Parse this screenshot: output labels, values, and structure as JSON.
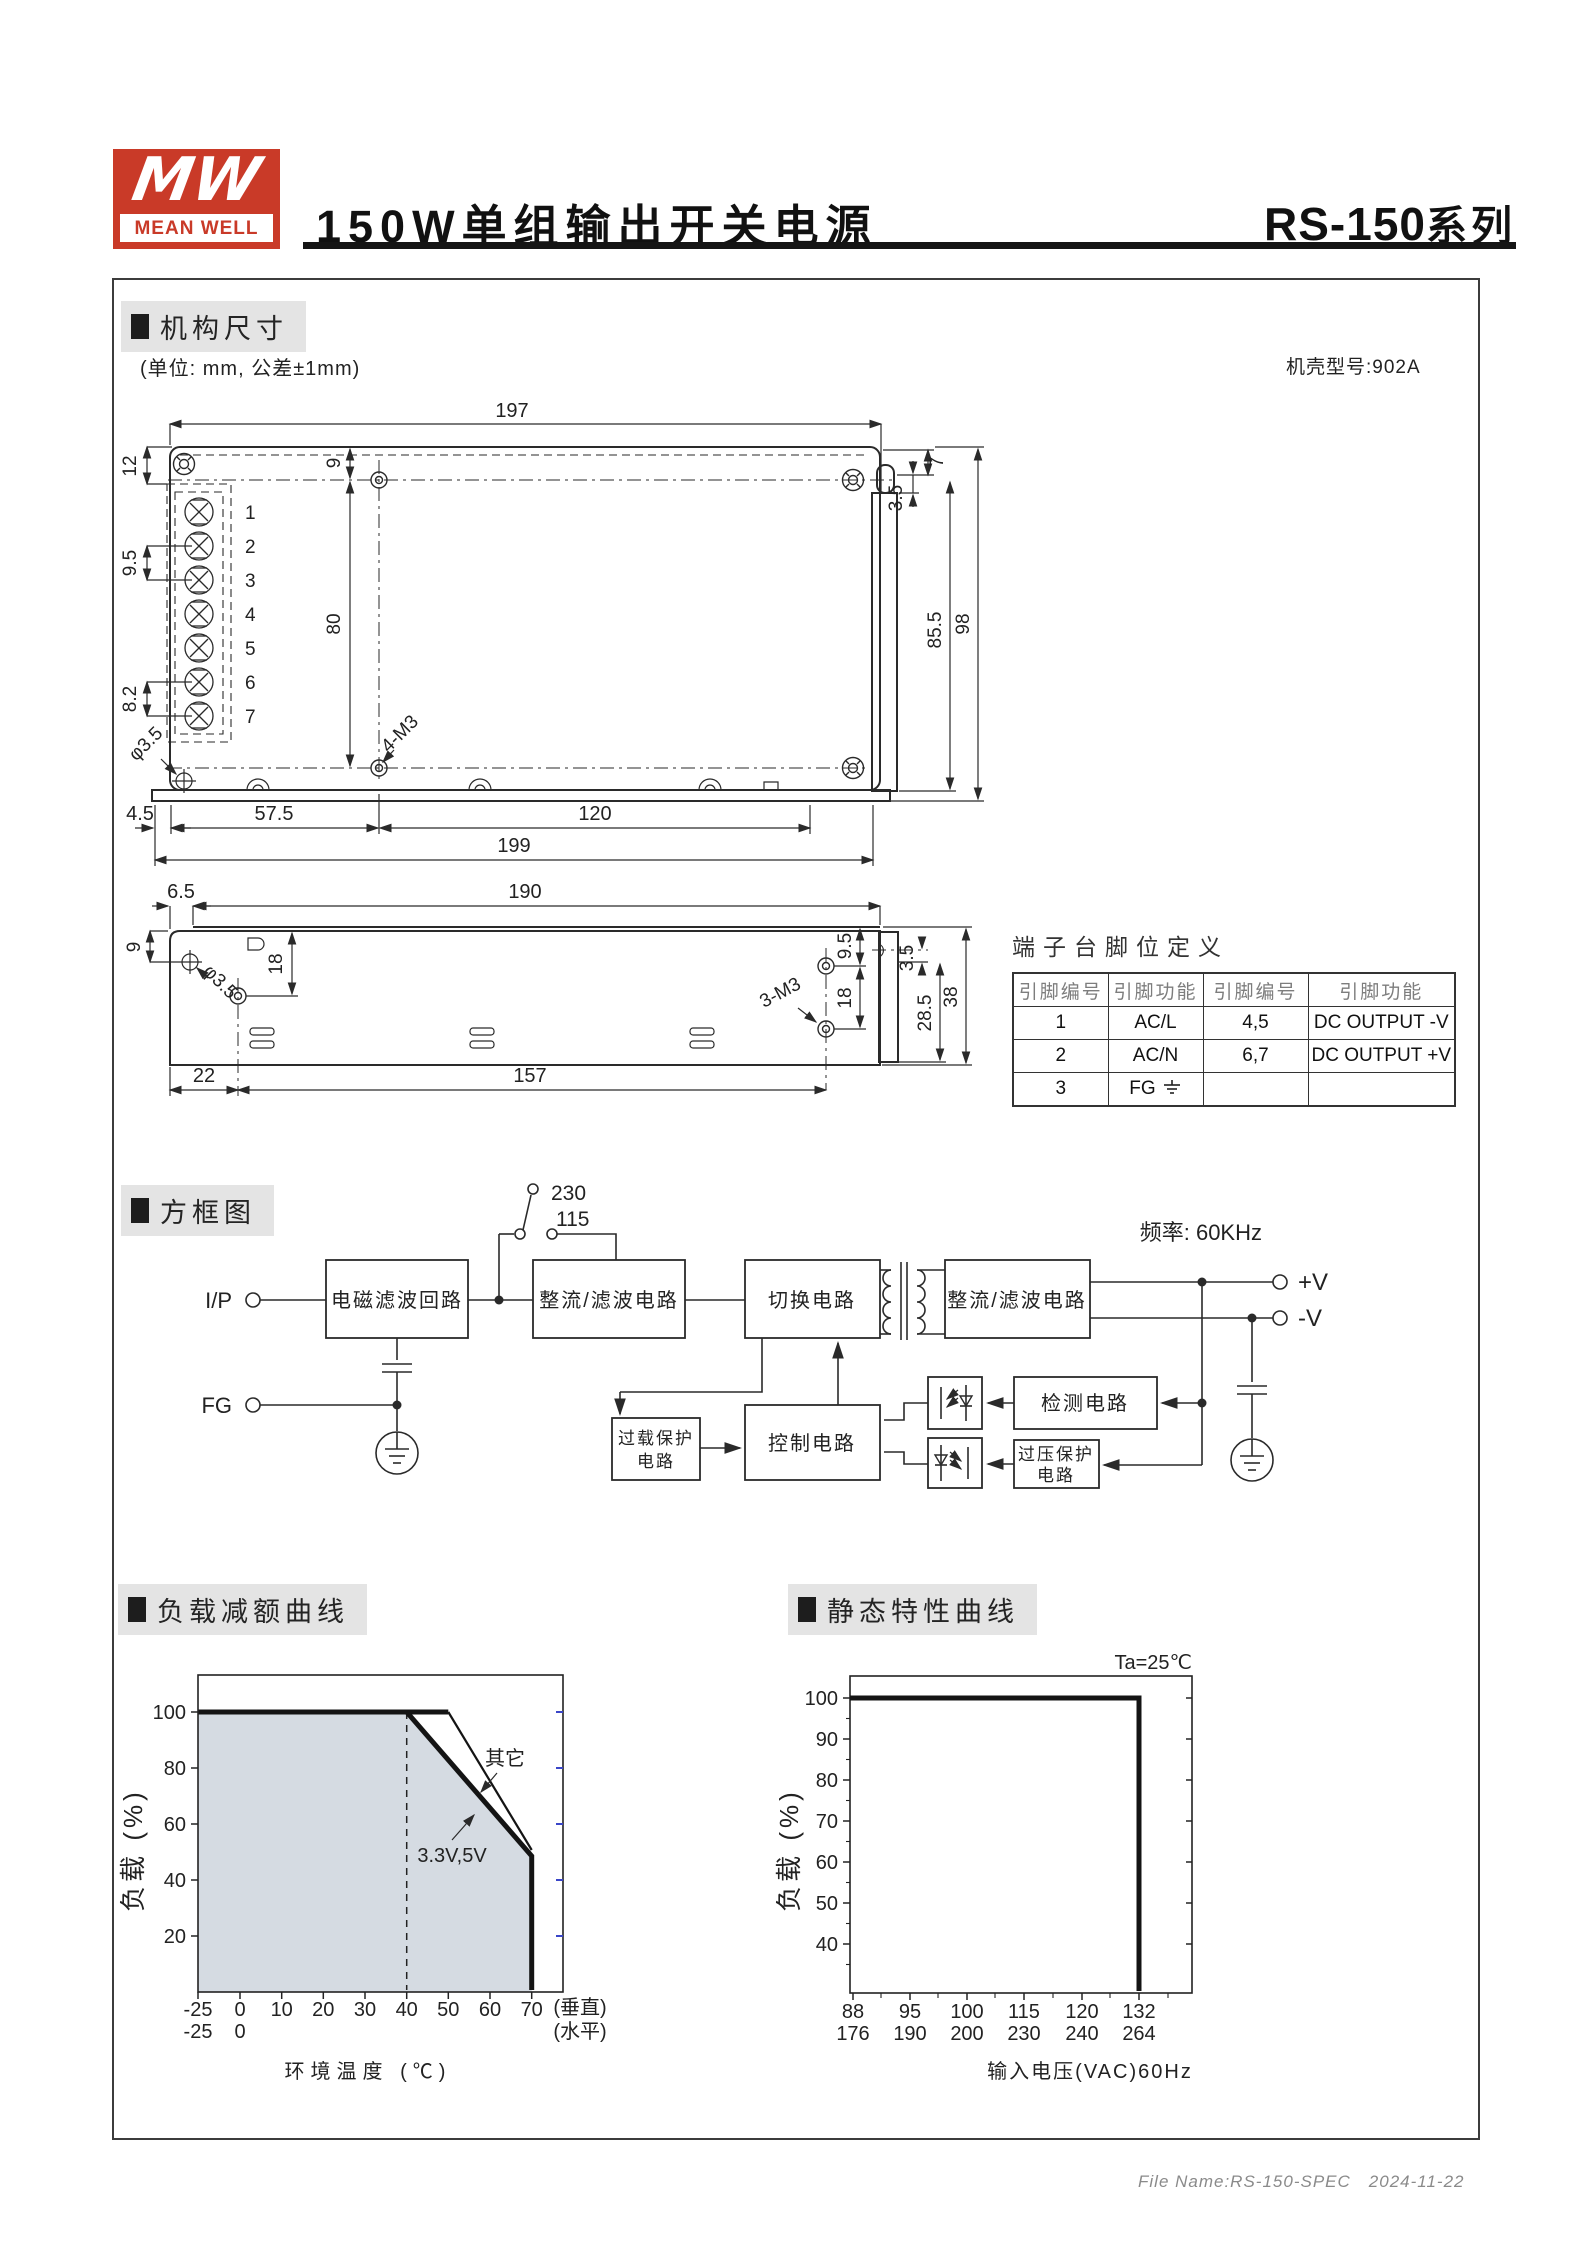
{
  "colors": {
    "accent_red": "#c93a28",
    "section_bg": "#e4e4e4",
    "chart_fill": "#d5dbe2",
    "tick_blue": "#3a46c8"
  },
  "header": {
    "logo_mw": "MW",
    "logo_meanwell": "MEAN WELL",
    "title": "150W单组输出开关电源",
    "series": "RS-150",
    "series_suffix": "系列"
  },
  "sections": {
    "mech": "机构尺寸",
    "block": "方框图",
    "derating": "负载减额曲线",
    "static": "静态特性曲线"
  },
  "notes": {
    "unit": "(单位: mm, 公差±1mm)",
    "case": "机壳型号:902A",
    "freq": "频率: 60KHz",
    "ta": "Ta=25℃"
  },
  "mech": {
    "terminals": [
      "1",
      "2",
      "3",
      "4",
      "5",
      "6",
      "7"
    ],
    "dims": {
      "t197": "197",
      "t12": "12",
      "t95": "9.5",
      "t82": "8.2",
      "t9": "9",
      "t80": "80",
      "tphi": "φ3.5",
      "t4m3": "4-M3",
      "t45": "4.5",
      "t575": "57.5",
      "t120": "120",
      "t199": "199",
      "t7": "7",
      "t35": "3.5",
      "t855": "85.5",
      "t98": "98",
      "s65": "6.5",
      "s190": "190",
      "s9": "9",
      "s18": "18",
      "sphi": "φ3.5",
      "s22": "22",
      "s157": "157",
      "s3m3": "3-M3",
      "s95": "9.5",
      "s18b": "18",
      "s35": "3.5",
      "s285": "28.5",
      "s38": "38"
    },
    "pin_table": {
      "title": "端子台脚位定义",
      "headers": [
        "引脚编号",
        "引脚功能",
        "引脚编号",
        "引脚功能"
      ],
      "rows": [
        [
          "1",
          "AC/L",
          "4,5",
          "DC OUTPUT -V"
        ],
        [
          "2",
          "AC/N",
          "6,7",
          "DC OUTPUT +V"
        ],
        [
          "3",
          "FG",
          "",
          ""
        ]
      ]
    }
  },
  "block": {
    "labels": {
      "ip": "I/P",
      "fg": "FG",
      "sw230": "230",
      "sw115": "115",
      "emi": "电磁滤波回路",
      "rect1": "整流/滤波电路",
      "switch": "切换电路",
      "rect2": "整流/滤波电路",
      "detect": "检测电路",
      "ovp1": "过压保护",
      "ovp2": "电路",
      "olp1": "过载保护",
      "olp2": "电路",
      "ctrl": "控制电路",
      "vplus": "+V",
      "vminus": "-V"
    }
  },
  "chart_data": [
    {
      "type": "line",
      "title": "负载减额曲线",
      "xlabel": "环境温度 (℃)",
      "ylabel": "负载 (%)",
      "x_ticks": [
        "-25",
        "0",
        "10",
        "20",
        "30",
        "40",
        "50",
        "60",
        "70"
      ],
      "x_ticks_row2": [
        "-25",
        "0"
      ],
      "right_labels": [
        "(垂直)",
        "(水平)"
      ],
      "y_ticks": [
        "100",
        "80",
        "60",
        "40",
        "20"
      ],
      "ylim": [
        0,
        110
      ],
      "x_axis_note": "ticks uniformly spaced; -25 placed one step left of 0",
      "dashed_guide_x": 40,
      "fill_color": "#d5dbe2",
      "series": [
        {
          "name": "其它",
          "points": [
            [
              -25,
              100
            ],
            [
              50,
              100
            ],
            [
              70,
              50
            ],
            [
              70,
              0
            ]
          ]
        },
        {
          "name": "3.3V,5V",
          "points": [
            [
              -25,
              100
            ],
            [
              40,
              100
            ],
            [
              70,
              48
            ],
            [
              70,
              0
            ]
          ]
        }
      ]
    },
    {
      "type": "line",
      "title": "静态特性曲线",
      "xlabel": "输入电压(VAC)60Hz",
      "ylabel": "负载 (%)",
      "annotation": "Ta=25℃",
      "x_ticks_row1": [
        "88",
        "95",
        "100",
        "115",
        "120",
        "132"
      ],
      "x_ticks_row2": [
        "176",
        "190",
        "200",
        "230",
        "240",
        "264"
      ],
      "y_ticks": [
        "100",
        "90",
        "80",
        "70",
        "60",
        "50",
        "40"
      ],
      "ylim": [
        30,
        105
      ],
      "series": [
        {
          "name": "load",
          "points": [
            [
              88,
              100
            ],
            [
              132,
              100
            ],
            [
              132,
              0
            ]
          ]
        }
      ]
    }
  ],
  "footer": {
    "file_name": "File Name:RS-150-SPEC",
    "date": "2024-11-22"
  }
}
